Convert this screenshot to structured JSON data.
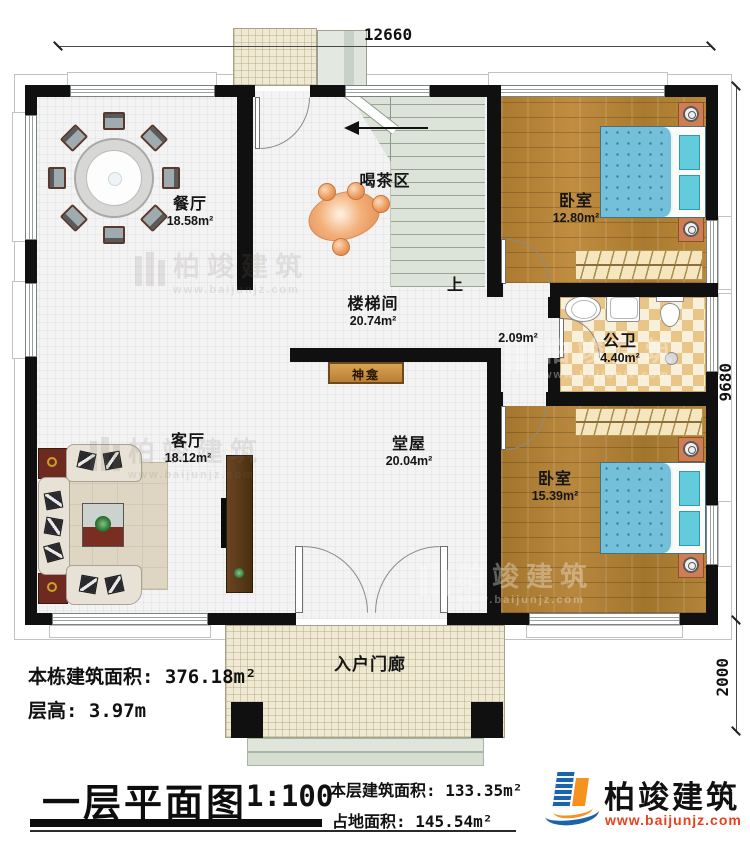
{
  "dimensions": {
    "top": "12660",
    "right_main": "9680",
    "right_porch": "2000"
  },
  "rooms": {
    "dining": {
      "label": "餐厅",
      "area": "18.58m²"
    },
    "tea": {
      "label": "喝茶区"
    },
    "stairwell": {
      "label": "楼梯间",
      "area": "20.74m²"
    },
    "bedroom1": {
      "label": "卧室",
      "area": "12.80m²"
    },
    "bathroom": {
      "label": "公卫",
      "area": "4.40m²"
    },
    "corridor": {
      "area": "2.09m²"
    },
    "shrine": {
      "label": "神龛"
    },
    "hall": {
      "label": "堂屋",
      "area": "20.04m²"
    },
    "living": {
      "label": "客厅",
      "area": "18.12m²"
    },
    "bedroom2": {
      "label": "卧室",
      "area": "15.39m²"
    },
    "porch": {
      "label": "入户门廊"
    }
  },
  "stairs": {
    "up_label": "上"
  },
  "info": {
    "building_area_label": "本栋建筑面积: ",
    "building_area_value": "376.18m²",
    "floor_height_label": "层高: ",
    "floor_height_value": "3.97m"
  },
  "title_block": {
    "title": "一层平面图",
    "scale": "1:100",
    "floor_area_label": "本层建筑面积: ",
    "floor_area_value": "133.35m²",
    "land_area_label": "占地面积: ",
    "land_area_value": "145.54m²"
  },
  "brand": {
    "name": "柏竣建筑",
    "website": "www.baijunjz.com"
  },
  "watermark": {
    "name": "柏竣建筑",
    "website": "www.baijunjz.com"
  },
  "colors": {
    "wall": "#101010",
    "wood_floor": "#b2813a",
    "bed_blue": "#74c0da",
    "brand_blue": "#1b63ab",
    "brand_orange": "#f6921e",
    "url_red": "#e8421c"
  }
}
